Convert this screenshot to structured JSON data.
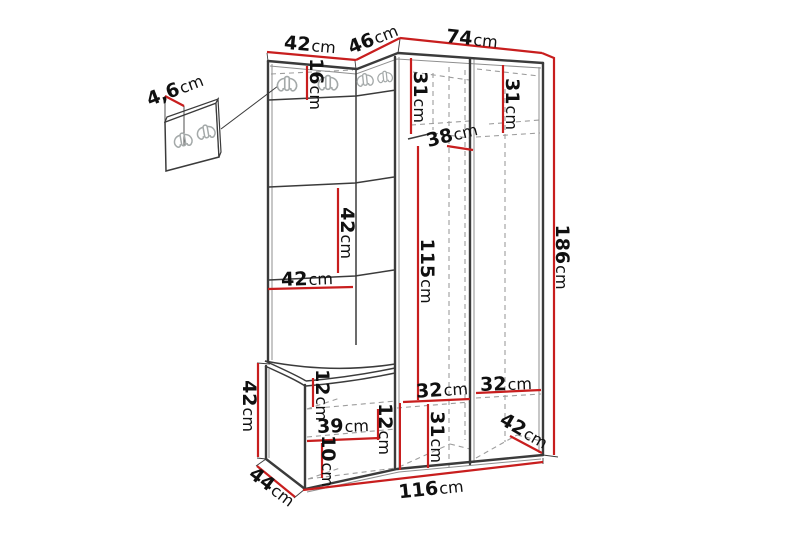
{
  "diagram": {
    "type": "furniture-dimension-drawing",
    "colors": {
      "outline": "#3b3b3b",
      "secondary": "#8f8f8f",
      "hidden": "#9d9d9d",
      "dimension": "#c81e1e",
      "label": "#101010",
      "hook": "#a4a9a9",
      "background": "#ffffff"
    },
    "dimensions": [
      {
        "id": "wall-panel-thickness",
        "value": "4,6",
        "unit": "cm"
      },
      {
        "id": "top-left-width",
        "value": "42",
        "unit": "cm"
      },
      {
        "id": "top-corner-width",
        "value": "46",
        "unit": "cm"
      },
      {
        "id": "top-right-width",
        "value": "74",
        "unit": "cm"
      },
      {
        "id": "hook-strip-height",
        "value": "16",
        "unit": "cm"
      },
      {
        "id": "upper-left-compartment-height",
        "value": "31",
        "unit": "cm"
      },
      {
        "id": "upper-right-compartment-height",
        "value": "31",
        "unit": "cm"
      },
      {
        "id": "corner-shelf-depth",
        "value": "38",
        "unit": "cm"
      },
      {
        "id": "left-panel-section-height",
        "value": "42",
        "unit": "cm"
      },
      {
        "id": "left-column-width",
        "value": "42",
        "unit": "cm"
      },
      {
        "id": "middle-section-height",
        "value": "115",
        "unit": "cm"
      },
      {
        "id": "total-height",
        "value": "186",
        "unit": "cm"
      },
      {
        "id": "bench-upper-compartment-height",
        "value": "12",
        "unit": "cm"
      },
      {
        "id": "bench-inner-width",
        "value": "39",
        "unit": "cm"
      },
      {
        "id": "bench-right-compartment-height",
        "value": "12",
        "unit": "cm"
      },
      {
        "id": "bench-lower-compartment-height",
        "value": "10",
        "unit": "cm"
      },
      {
        "id": "bench-height",
        "value": "42",
        "unit": "cm"
      },
      {
        "id": "bench-depth",
        "value": "44",
        "unit": "cm"
      },
      {
        "id": "lower-left-compartment-height",
        "value": "32",
        "unit": "cm"
      },
      {
        "id": "lower-right-compartment-height",
        "value": "32",
        "unit": "cm"
      },
      {
        "id": "bottom-compartment-height",
        "value": "31",
        "unit": "cm"
      },
      {
        "id": "bottom-right-depth",
        "value": "42",
        "unit": "cm"
      },
      {
        "id": "total-width",
        "value": "116",
        "unit": "cm"
      }
    ]
  }
}
